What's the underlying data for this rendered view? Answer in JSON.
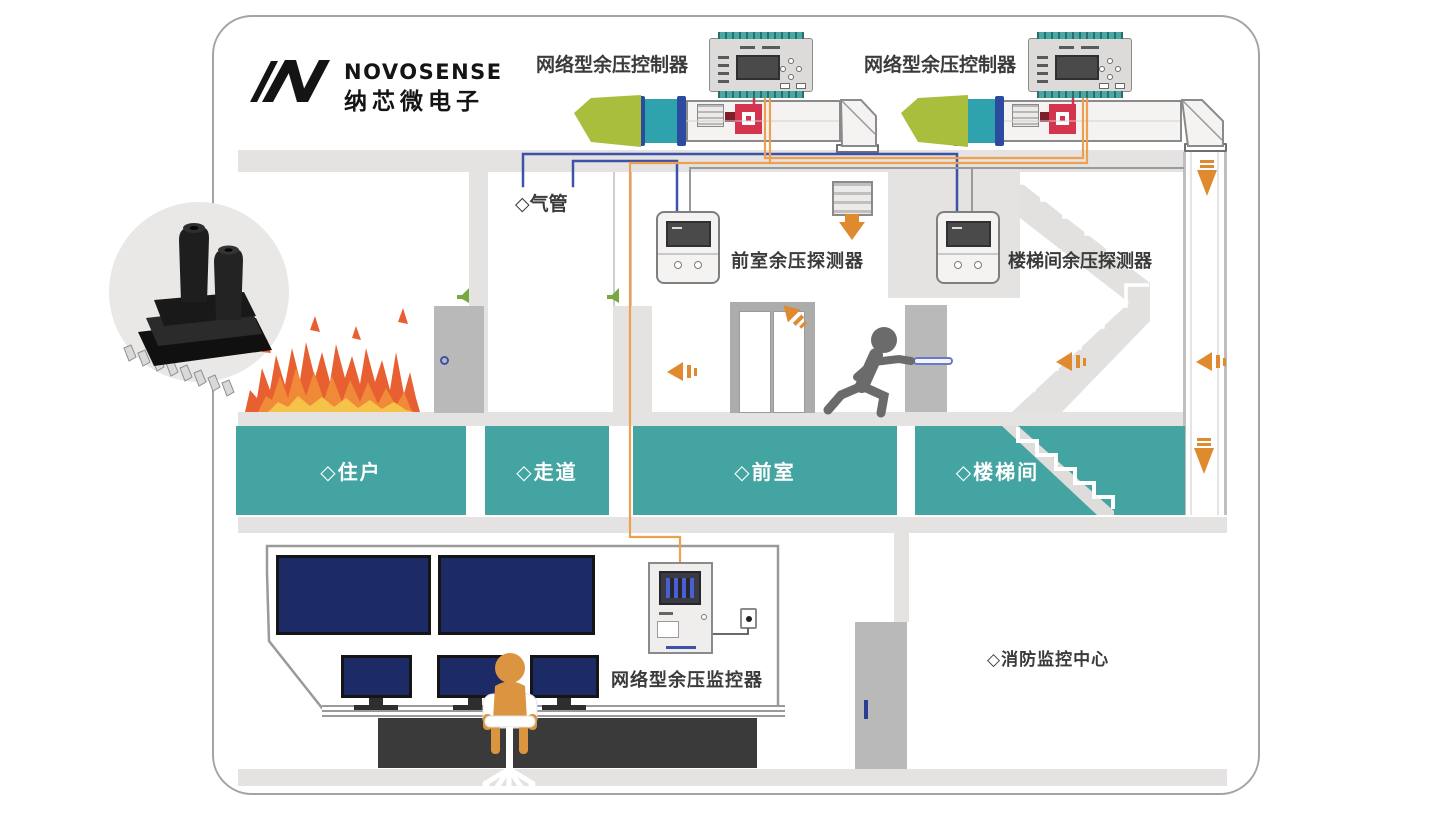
{
  "logo": {
    "brand": "NOVOSENSE",
    "brand_cn": "纳芯微电子"
  },
  "labels": {
    "controller_left": "网络型余压控制器",
    "controller_right": "网络型余压控制器",
    "air_tube": "◇气管",
    "front_room_detector": "前室余压探测器",
    "stairwell_detector": "楼梯间余压探测器",
    "network_monitor": "网络型余压监控器",
    "fire_control_center": "◇消防监控中心"
  },
  "rooms": {
    "resident": "◇住户",
    "corridor": "◇走道",
    "front_room": "◇前室",
    "stairwell": "◇楼梯间"
  },
  "colors": {
    "teal_room": "#44A4A2",
    "airflow_orange": "#E08A30",
    "wire_orange": "#EDA14E",
    "wire_blue": "#3D52A8",
    "wire_gray": "#9A9A9A",
    "wire_red": "#D4344E",
    "fan_green": "#A9BE3C",
    "duct_teal": "#2FA3AD",
    "flange_blue": "#2B4AA0",
    "screen_navy": "#1C2A66",
    "person_orange": "#DB9440",
    "wall_gray": "#E4E3E1",
    "door_gray": "#B9B9B9",
    "flame_red": "#E86032",
    "flame_orange": "#F08A38",
    "flame_yellow": "#F5C34A"
  }
}
